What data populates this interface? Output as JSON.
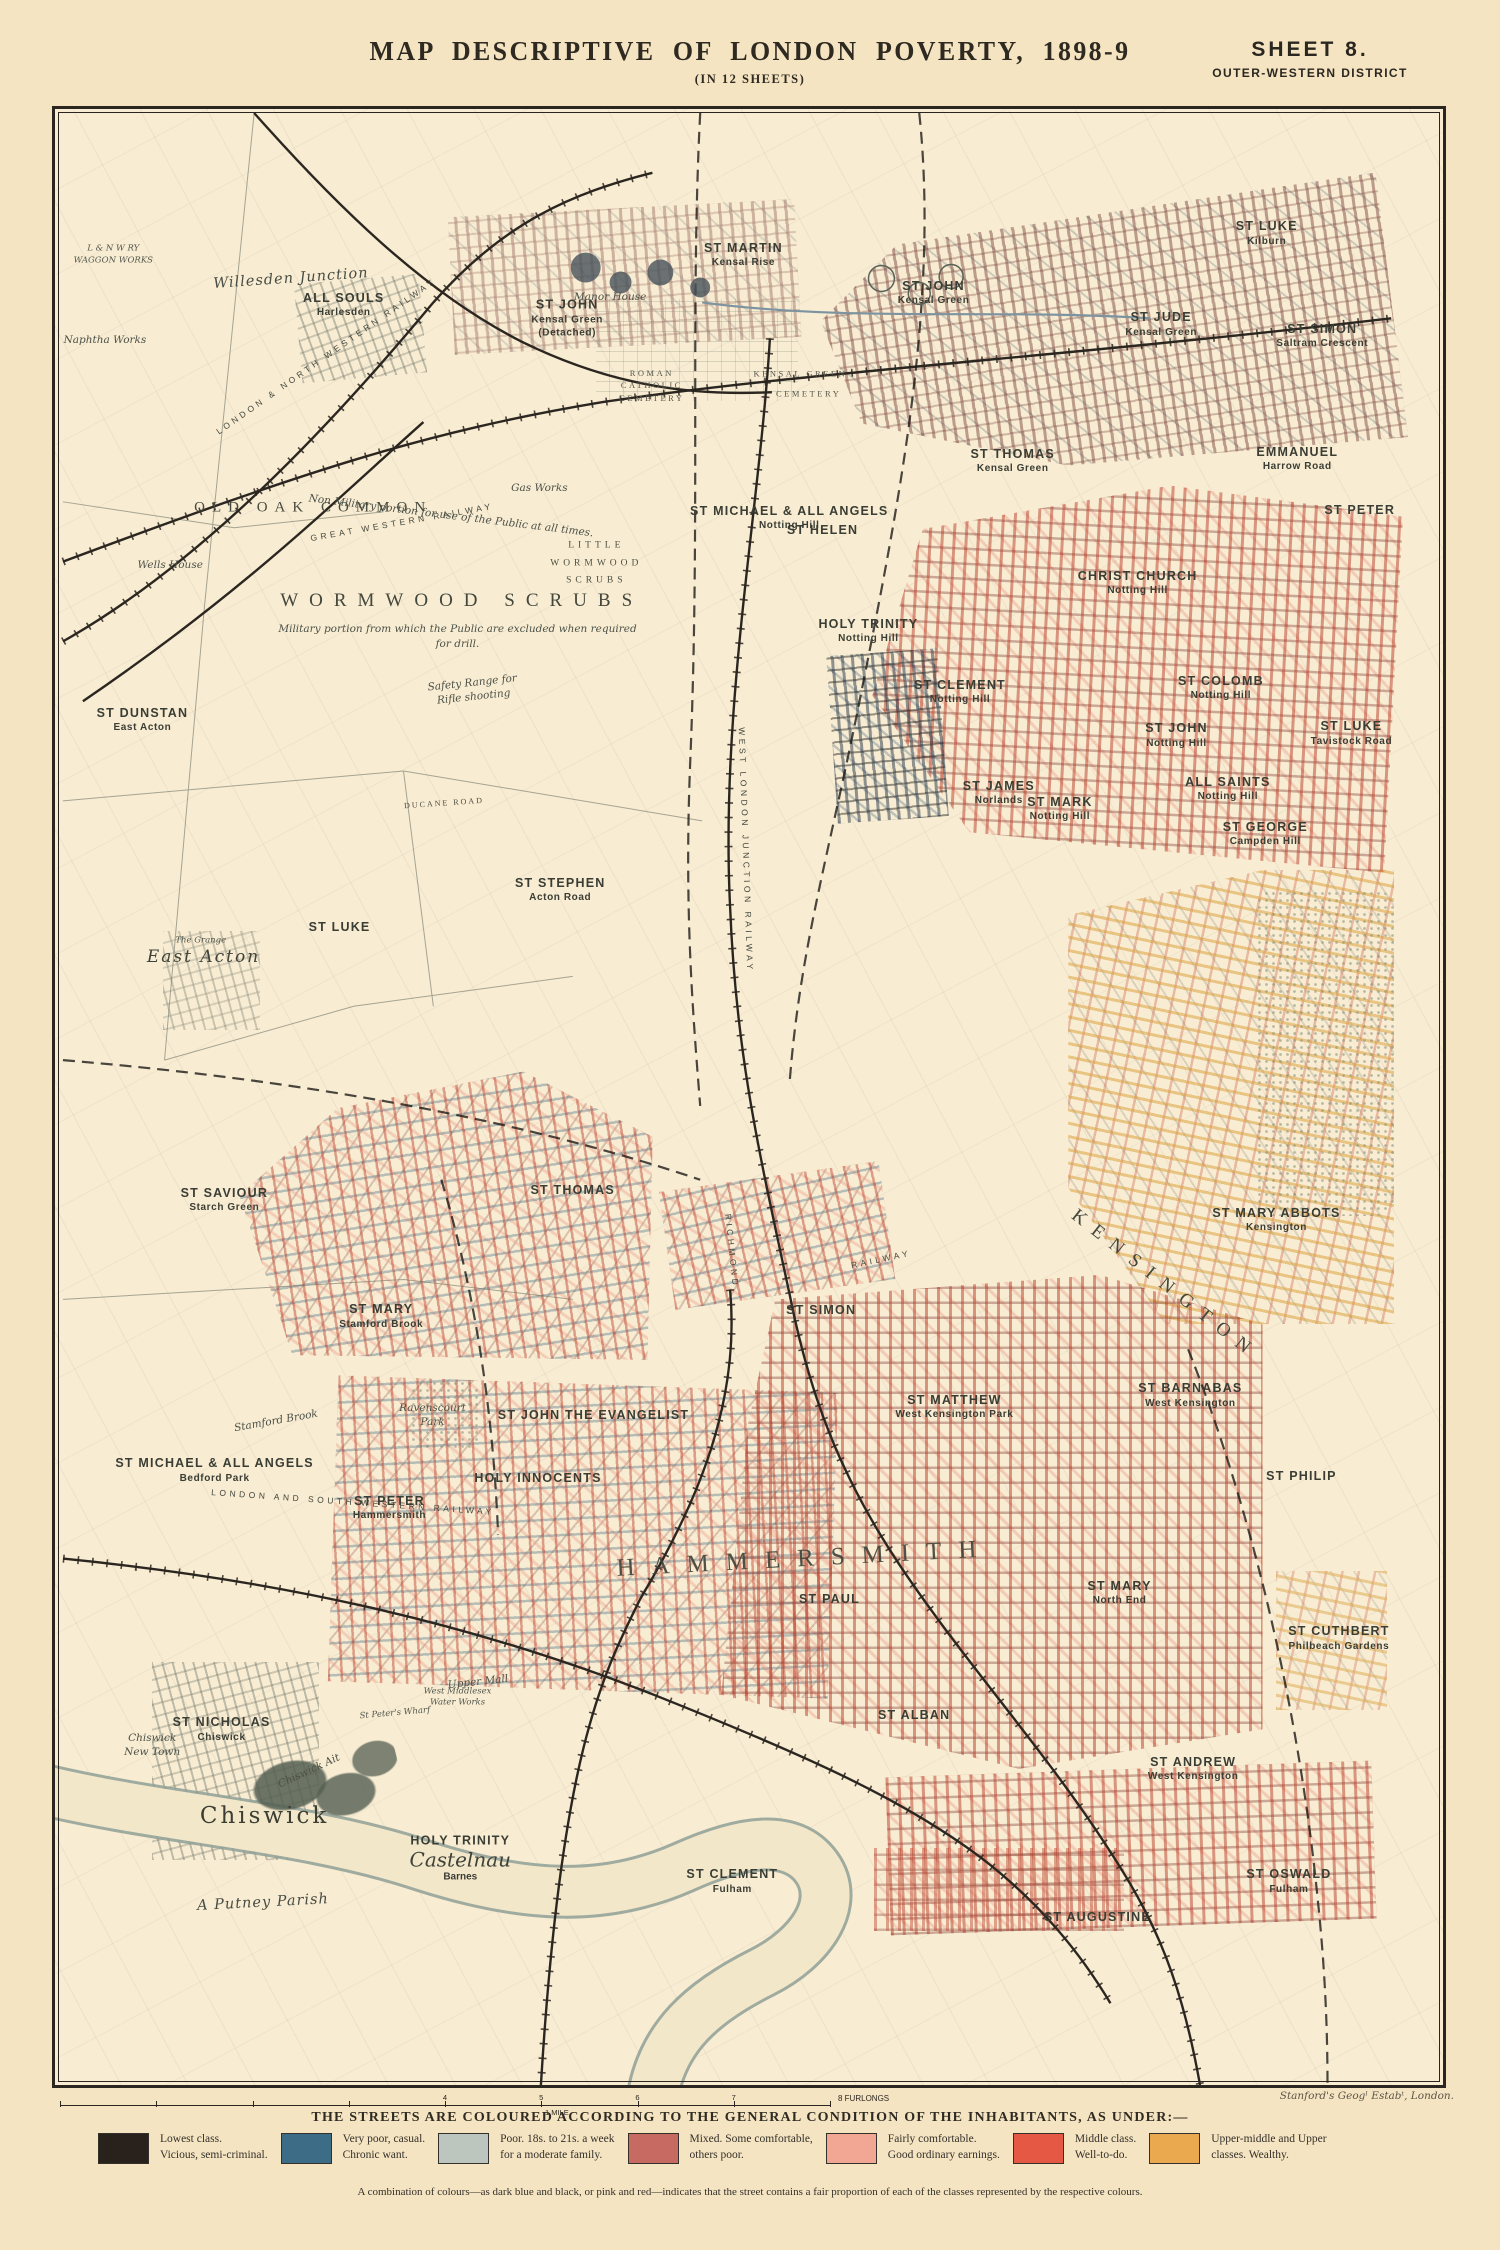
{
  "header": {
    "title": "MAP DESCRIPTIVE OF LONDON POVERTY, 1898-9",
    "subtitle": "(IN 12 SHEETS)",
    "sheet": "SHEET 8.",
    "district": "OUTER-WESTERN DISTRICT"
  },
  "scale": {
    "ticks": [
      "4",
      "5",
      "6",
      "7"
    ],
    "end_label": "8 FURLONGS",
    "mile_label": "1 MILE"
  },
  "legend": {
    "heading": "THE STREETS ARE COLOURED ACCORDING TO THE GENERAL CONDITION OF THE INHABITANTS, AS UNDER:—",
    "note": "A combination of colours—as dark blue and black, or pink and red—indicates that the street contains a fair proportion of each of the classes represented by the respective colours.",
    "items": [
      {
        "color": "#29211b",
        "line1": "Lowest class.",
        "line2": "Vicious, semi-criminal."
      },
      {
        "color": "#3d6c86",
        "line1": "Very poor, casual.",
        "line2": "Chronic want."
      },
      {
        "color": "#bcc6bf",
        "line1": "Poor.  18s. to 21s. a week",
        "line2": "for a moderate family."
      },
      {
        "color": "#c76a61",
        "line1": "Mixed.  Some comfortable,",
        "line2": "others poor."
      },
      {
        "color": "#f2a795",
        "line1": "Fairly comfortable.",
        "line2": "Good ordinary earnings."
      },
      {
        "color": "#e55843",
        "line1": "Middle class.",
        "line2": "Well-to-do."
      },
      {
        "color": "#eaa94e",
        "line1": "Upper-middle and Upper",
        "line2": "classes.  Wealthy."
      }
    ]
  },
  "imprint": "Stanford's Geogˡ Estabᵗ, London.",
  "map": {
    "labels": [
      {
        "x": 49.6,
        "y": 7.4,
        "cls": "parish",
        "lines": [
          "ST MARTIN",
          "Kensal Rise"
        ]
      },
      {
        "x": 20.8,
        "y": 9.9,
        "cls": "parish",
        "lines": [
          "ALL SOULS",
          "Harlesden"
        ]
      },
      {
        "x": 36.9,
        "y": 10.6,
        "cls": "parish",
        "lines": [
          "ST JOHN",
          "Kensal Green",
          "(Detached)"
        ]
      },
      {
        "x": 63.3,
        "y": 9.3,
        "cls": "parish",
        "lines": [
          "ST JOHN",
          "Kensal Green"
        ]
      },
      {
        "x": 79.7,
        "y": 10.9,
        "cls": "parish",
        "lines": [
          "ST JUDE",
          "Kensal Green"
        ]
      },
      {
        "x": 87.3,
        "y": 6.3,
        "cls": "parish",
        "lines": [
          "ST LUKE",
          "Kilburn"
        ]
      },
      {
        "x": 91.3,
        "y": 11.5,
        "cls": "parish",
        "lines": [
          "ST SIMON",
          "Saltram Crescent"
        ]
      },
      {
        "x": 89.5,
        "y": 17.7,
        "cls": "parish",
        "lines": [
          "EMMANUEL",
          "Harrow Road"
        ]
      },
      {
        "x": 94.0,
        "y": 20.3,
        "cls": "parish",
        "lines": [
          "ST PETER"
        ]
      },
      {
        "x": 69.0,
        "y": 17.8,
        "cls": "parish",
        "lines": [
          "ST THOMAS",
          "Kensal Green"
        ]
      },
      {
        "x": 52.9,
        "y": 20.7,
        "cls": "parish",
        "lines": [
          "ST MICHAEL & ALL ANGELS",
          "Notting Hill"
        ]
      },
      {
        "x": 78.0,
        "y": 24.0,
        "cls": "parish",
        "lines": [
          "CHRIST CHURCH",
          "Notting Hill"
        ]
      },
      {
        "x": 55.3,
        "y": 21.3,
        "cls": "parish",
        "lines": [
          "ST HELEN"
        ]
      },
      {
        "x": 84.0,
        "y": 29.3,
        "cls": "parish",
        "lines": [
          "ST COLOMB",
          "Notting Hill"
        ]
      },
      {
        "x": 72.4,
        "y": 35.4,
        "cls": "parish",
        "lines": [
          "ST MARK",
          "Notting Hill"
        ]
      },
      {
        "x": 84.5,
        "y": 34.4,
        "cls": "parish",
        "lines": [
          "ALL SAINTS",
          "Notting Hill"
        ]
      },
      {
        "x": 93.4,
        "y": 31.6,
        "cls": "parish",
        "lines": [
          "ST LUKE",
          "Tavistock Road"
        ]
      },
      {
        "x": 58.6,
        "y": 26.4,
        "cls": "parish",
        "lines": [
          "HOLY TRINITY",
          "Notting Hill"
        ]
      },
      {
        "x": 65.2,
        "y": 29.5,
        "cls": "parish",
        "lines": [
          "ST CLEMENT",
          "Notting Hill"
        ]
      },
      {
        "x": 80.8,
        "y": 31.7,
        "cls": "parish",
        "lines": [
          "ST JOHN",
          "Notting Hill"
        ]
      },
      {
        "x": 68.0,
        "y": 34.6,
        "cls": "parish",
        "lines": [
          "ST JAMES",
          "Norlands"
        ]
      },
      {
        "x": 87.2,
        "y": 36.7,
        "cls": "parish",
        "lines": [
          "ST GEORGE",
          "Campden Hill"
        ]
      },
      {
        "x": 6.3,
        "y": 30.9,
        "cls": "parish",
        "lines": [
          "ST DUNSTAN",
          "East Acton"
        ]
      },
      {
        "x": 20.5,
        "y": 41.4,
        "cls": "parish",
        "lines": [
          "ST LUKE"
        ]
      },
      {
        "x": 36.4,
        "y": 39.5,
        "cls": "parish",
        "lines": [
          "ST STEPHEN",
          "Acton Road"
        ]
      },
      {
        "x": 88.0,
        "y": 56.2,
        "cls": "parish",
        "lines": [
          "ST MARY ABBOTS",
          "Kensington"
        ]
      },
      {
        "x": 12.2,
        "y": 55.2,
        "cls": "parish",
        "lines": [
          "ST SAVIOUR",
          "Starch Green"
        ]
      },
      {
        "x": 37.3,
        "y": 54.7,
        "cls": "parish",
        "lines": [
          "ST THOMAS"
        ]
      },
      {
        "x": 23.5,
        "y": 61.1,
        "cls": "parish",
        "lines": [
          "ST MARY",
          "Stamford Brook"
        ]
      },
      {
        "x": 11.5,
        "y": 68.9,
        "cls": "parish",
        "lines": [
          "ST MICHAEL & ALL ANGELS",
          "Bedford Park"
        ]
      },
      {
        "x": 55.2,
        "y": 60.8,
        "cls": "parish",
        "lines": [
          "ST SIMON"
        ]
      },
      {
        "x": 64.8,
        "y": 65.7,
        "cls": "parish",
        "lines": [
          "ST MATTHEW",
          "West Kensington Park"
        ]
      },
      {
        "x": 81.8,
        "y": 65.1,
        "cls": "parish",
        "lines": [
          "ST BARNABAS",
          "West Kensington"
        ]
      },
      {
        "x": 38.8,
        "y": 66.1,
        "cls": "parish",
        "lines": [
          "ST JOHN THE EVANGELIST"
        ]
      },
      {
        "x": 34.8,
        "y": 69.3,
        "cls": "parish",
        "lines": [
          "HOLY INNOCENTS"
        ]
      },
      {
        "x": 24.1,
        "y": 70.8,
        "cls": "parish",
        "lines": [
          "ST PETER",
          "Hammersmith"
        ]
      },
      {
        "x": 55.8,
        "y": 75.4,
        "cls": "parish",
        "lines": [
          "ST PAUL"
        ]
      },
      {
        "x": 89.8,
        "y": 69.2,
        "cls": "parish",
        "lines": [
          "ST PHILIP"
        ]
      },
      {
        "x": 76.7,
        "y": 75.1,
        "cls": "parish",
        "lines": [
          "ST MARY",
          "North End"
        ]
      },
      {
        "x": 92.5,
        "y": 77.4,
        "cls": "parish",
        "lines": [
          "ST CUTHBERT",
          "Philbeach Gardens"
        ]
      },
      {
        "x": 12.0,
        "y": 82.0,
        "cls": "parish",
        "lines": [
          "ST NICHOLAS",
          "Chiswick"
        ]
      },
      {
        "x": 61.9,
        "y": 81.3,
        "cls": "parish",
        "lines": [
          "ST ALBAN"
        ]
      },
      {
        "x": 82.0,
        "y": 84.0,
        "cls": "parish",
        "lines": [
          "ST ANDREW",
          "West Kensington"
        ]
      },
      {
        "x": 29.2,
        "y": 88.5,
        "cls": "castelnau",
        "lines": [
          "HOLY TRINITY",
          "Castelnau",
          "Barnes"
        ]
      },
      {
        "x": 48.8,
        "y": 89.7,
        "cls": "parish",
        "lines": [
          "ST CLEMENT",
          "Fulham"
        ]
      },
      {
        "x": 75.1,
        "y": 91.5,
        "cls": "parish",
        "lines": [
          "ST AUGUSTINE"
        ]
      },
      {
        "x": 88.9,
        "y": 89.7,
        "cls": "parish",
        "lines": [
          "ST OSWALD",
          "Fulham"
        ]
      },
      {
        "x": 18.6,
        "y": 20.2,
        "cls": "area",
        "lines": [
          "OLD OAK COMMON"
        ]
      },
      {
        "x": 29.3,
        "y": 24.9,
        "cls": "area-lg",
        "lines": [
          "WORMWOOD SCRUBS"
        ]
      },
      {
        "x": 29.0,
        "y": 26.3,
        "cls": "topo",
        "lines": [
          "Military portion from which the Public are excluded when required"
        ]
      },
      {
        "x": 29.0,
        "y": 27.1,
        "cls": "topo",
        "lines": [
          "for drill."
        ]
      },
      {
        "x": 39.0,
        "y": 23.0,
        "cls": "area-sm",
        "lines": [
          "LITTLE",
          "WORMWOOD",
          "SCRUBS"
        ]
      },
      {
        "x": 54.0,
        "y": 73.4,
        "cls": "area-xl",
        "rot": -3,
        "lines": [
          "HAMMERSMITH"
        ]
      },
      {
        "x": 80.0,
        "y": 59.5,
        "cls": "area-lg",
        "rot": 38,
        "lines": [
          "KENSINGTON"
        ]
      },
      {
        "x": 10.7,
        "y": 42.9,
        "cls": "place-it",
        "lines": [
          "East Acton"
        ]
      },
      {
        "x": 15.1,
        "y": 86.4,
        "cls": "place",
        "lines": [
          "Chiswick"
        ]
      },
      {
        "x": 17.0,
        "y": 8.6,
        "cls": "topo-lg",
        "rot": -4,
        "lines": [
          "Willesden Junction"
        ]
      },
      {
        "x": 28.5,
        "y": 20.6,
        "cls": "topo",
        "rot": 7,
        "lines": [
          "Non Military portion for use of the Public at all times."
        ]
      },
      {
        "x": 30.1,
        "y": 29.4,
        "cls": "topo",
        "rot": -6,
        "lines": [
          "Safety Range for",
          "Rifle shooting"
        ]
      },
      {
        "x": 34.9,
        "y": 19.2,
        "cls": "topo",
        "lines": [
          "Gas Works"
        ]
      },
      {
        "x": 8.3,
        "y": 23.1,
        "cls": "topo",
        "lines": [
          "Wells House"
        ]
      },
      {
        "x": 3.6,
        "y": 11.7,
        "cls": "topo",
        "lines": [
          "Naphtha Works"
        ]
      },
      {
        "x": 40.0,
        "y": 9.5,
        "cls": "topo",
        "lines": [
          "Manor House"
        ]
      },
      {
        "x": 15.9,
        "y": 66.4,
        "cls": "topo",
        "rot": -10,
        "lines": [
          "Stamford Brook"
        ]
      },
      {
        "x": 27.2,
        "y": 66.1,
        "cls": "topo",
        "lines": [
          "Ravenscourt",
          "Park"
        ]
      },
      {
        "x": 18.3,
        "y": 84.1,
        "cls": "topo",
        "rot": -25,
        "lines": [
          "Chiswick Ait"
        ]
      },
      {
        "x": 30.5,
        "y": 79.6,
        "cls": "topo",
        "rot": -6,
        "lines": [
          "Upper Mall"
        ]
      },
      {
        "x": 29.0,
        "y": 80.4,
        "cls": "topo-xs",
        "lines": [
          "West Middlesex",
          "Water Works"
        ]
      },
      {
        "x": 24.5,
        "y": 81.2,
        "cls": "topo-xs",
        "rot": -5,
        "lines": [
          "St Peter's Wharf"
        ]
      },
      {
        "x": 7.0,
        "y": 82.8,
        "cls": "topo",
        "lines": [
          "Chiswick",
          "New Town"
        ]
      },
      {
        "x": 15.0,
        "y": 90.8,
        "cls": "topo-lg",
        "rot": -3,
        "lines": [
          "A Putney Parish"
        ]
      },
      {
        "x": 10.5,
        "y": 42.1,
        "cls": "topo-xs",
        "lines": [
          "The Grange"
        ]
      },
      {
        "x": 28.0,
        "y": 35.1,
        "cls": "road",
        "rot": -4,
        "lines": [
          "DUCANE ROAD"
        ]
      },
      {
        "x": 53.7,
        "y": 13.4,
        "cls": "area-xs",
        "lines": [
          "KENSAL GREEN"
        ]
      },
      {
        "x": 54.3,
        "y": 14.4,
        "cls": "area-xs",
        "lines": [
          "CEMETERY"
        ]
      },
      {
        "x": 43.0,
        "y": 14.0,
        "cls": "area-xs",
        "lines": [
          "ROMAN",
          "CATHOLIC",
          "CEMETERY"
        ]
      },
      {
        "x": 25.0,
        "y": 20.9,
        "cls": "rwy",
        "rot": -10,
        "lines": [
          "GREAT WESTERN RAILWAY"
        ]
      },
      {
        "x": 21.5,
        "y": 70.5,
        "cls": "rwy",
        "rot": 4,
        "lines": [
          "LONDON AND SOUTH WESTERN RAILWAY"
        ]
      },
      {
        "x": 49.8,
        "y": 37.5,
        "cls": "rwy",
        "rot": 88,
        "lines": [
          "WEST LONDON JUNCTION RAILWAY"
        ]
      },
      {
        "x": 59.5,
        "y": 58.2,
        "cls": "rwy",
        "rot": -12,
        "lines": [
          "RAILWAY"
        ]
      },
      {
        "x": 48.8,
        "y": 57.8,
        "cls": "rwy",
        "rot": 84,
        "lines": [
          "RICHMOND"
        ]
      },
      {
        "x": 19.5,
        "y": 12.5,
        "cls": "rwy",
        "rot": -35,
        "lines": [
          "LONDON & NORTH WESTERN RAILWAY"
        ]
      },
      {
        "x": 4.2,
        "y": 7.4,
        "cls": "topo-xs",
        "lines": [
          "L & N W RY",
          "WAGGON WORKS"
        ]
      }
    ]
  }
}
